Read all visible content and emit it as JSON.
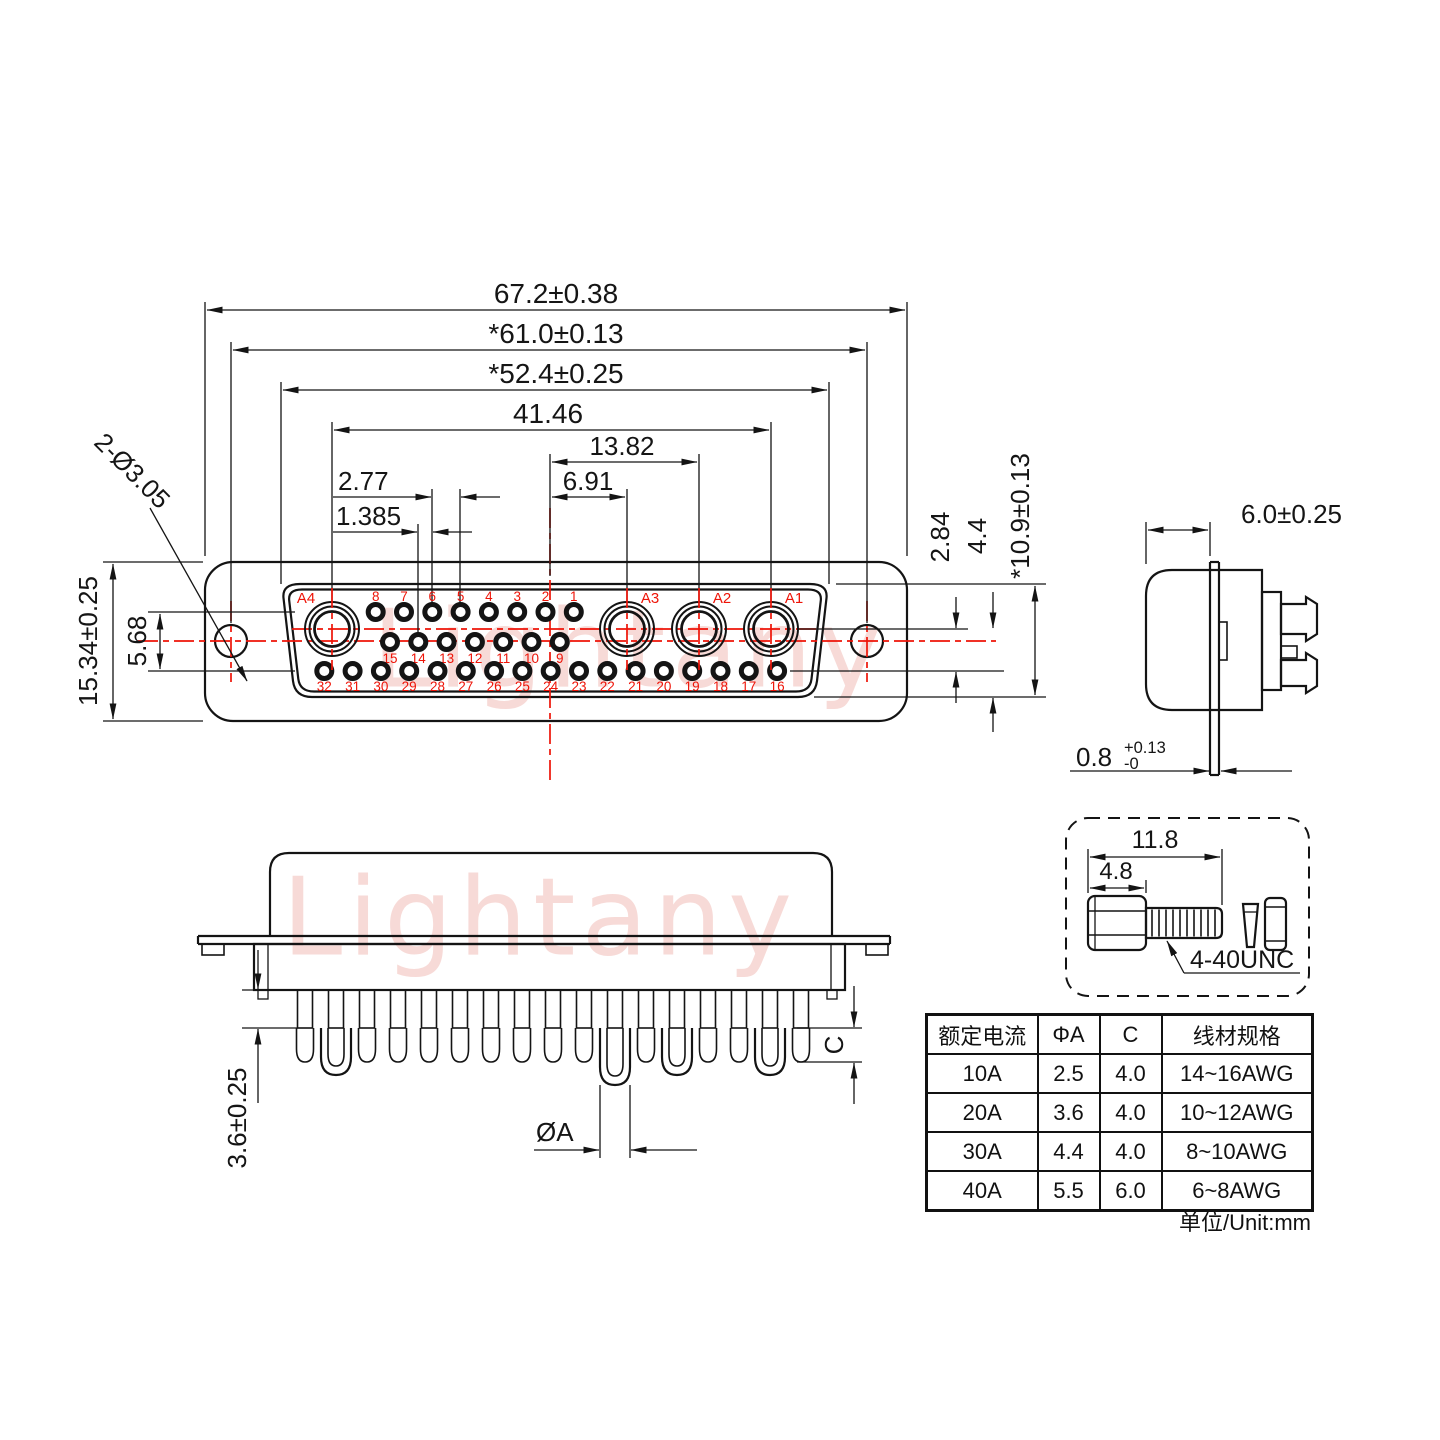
{
  "colors": {
    "line_black": "#141414",
    "centerline_red": "#ee1408",
    "watermark_pink": "#f6d2ce"
  },
  "watermark": {
    "text": "Lightany"
  },
  "front_view": {
    "dims": {
      "overall_width": "67.2±0.38",
      "hole_spacing": "*61.0±0.13",
      "shroud_width": "*52.4±0.25",
      "contact_span": "41.46",
      "center_to_a2": "13.82",
      "center_to_a3": "6.91",
      "pin_pitch": "2.77",
      "half_pitch": "1.385",
      "mount_hole": "2-Ø3.05",
      "plate_height": "15.34±0.25",
      "row_span": "5.68",
      "row_pitch": "2.84",
      "mid_height": "4.4",
      "shroud_height": "*10.9±0.13"
    },
    "pins": {
      "large": [
        "A4",
        "A3",
        "A2",
        "A1"
      ],
      "top": [
        "8",
        "7",
        "6",
        "5",
        "4",
        "3",
        "2",
        "1"
      ],
      "middle": [
        "15",
        "14",
        "13",
        "12",
        "11",
        "10",
        "9"
      ],
      "bottom": [
        "32",
        "31",
        "30",
        "29",
        "28",
        "27",
        "26",
        "25",
        "24",
        "23",
        "22",
        "21",
        "20",
        "19",
        "18",
        "17",
        "16"
      ]
    }
  },
  "side_view": {
    "dims": {
      "depth": "6.0±0.25",
      "flange_thickness": "0.8",
      "tol_plus": "+0.13",
      "tol_minus": "-0"
    }
  },
  "bottom_view": {
    "dims": {
      "tail_length": "3.6±0.25",
      "dia": "ØA",
      "c": "C"
    }
  },
  "screw_detail": {
    "dims": {
      "total_length": "11.8",
      "head_length": "4.8"
    },
    "thread": "4-40UNC"
  },
  "spec_table": {
    "headers": [
      "额定电流",
      "ΦA",
      "C",
      "线材规格"
    ],
    "rows": [
      [
        "10A",
        "2.5",
        "4.0",
        "14~16AWG"
      ],
      [
        "20A",
        "3.6",
        "4.0",
        "10~12AWG"
      ],
      [
        "30A",
        "4.4",
        "4.0",
        "8~10AWG"
      ],
      [
        "40A",
        "5.5",
        "6.0",
        "6~8AWG"
      ]
    ],
    "unit": "单位/Unit:mm"
  }
}
